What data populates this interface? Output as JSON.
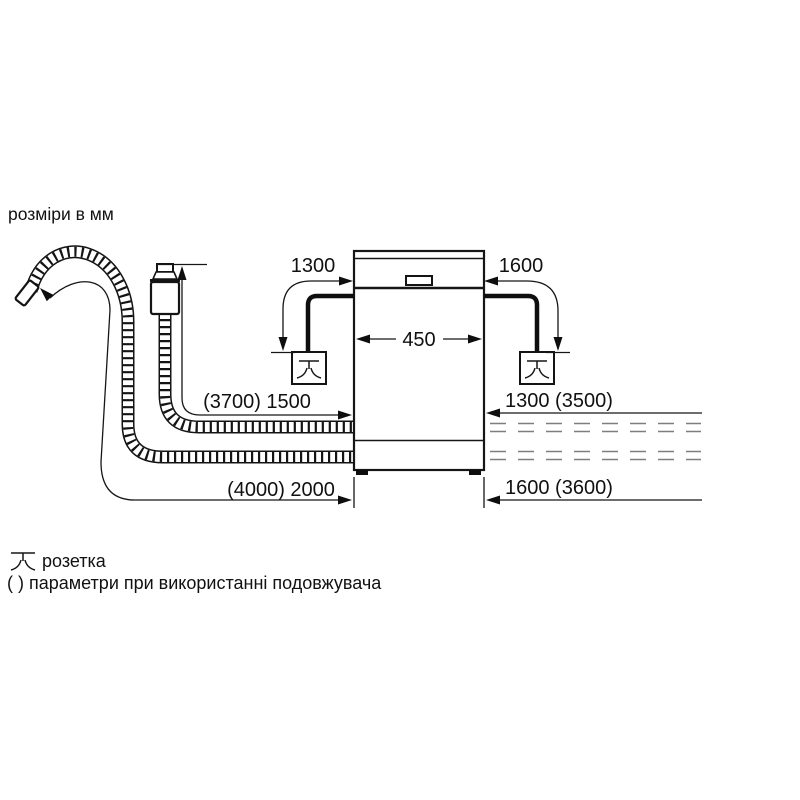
{
  "title": "розміри в мм",
  "diagram": {
    "appliance_width_mm": "450",
    "left_cord_length_mm": "1300",
    "right_cord_length_mm": "1600",
    "inlet_hose_left_mm": "(3700) 1500",
    "drain_hose_left_mm": "(4000) 2000",
    "inlet_hose_right_mm": "1300 (3500)",
    "drain_hose_right_mm": "1600 (3600)"
  },
  "legend": {
    "socket_label": "розетка",
    "parentheses_note": "( ) параметри при використанні подовжувача"
  },
  "colors": {
    "line": "#161616",
    "dashed_hose": "#7e7e7e",
    "background": "#ffffff"
  }
}
